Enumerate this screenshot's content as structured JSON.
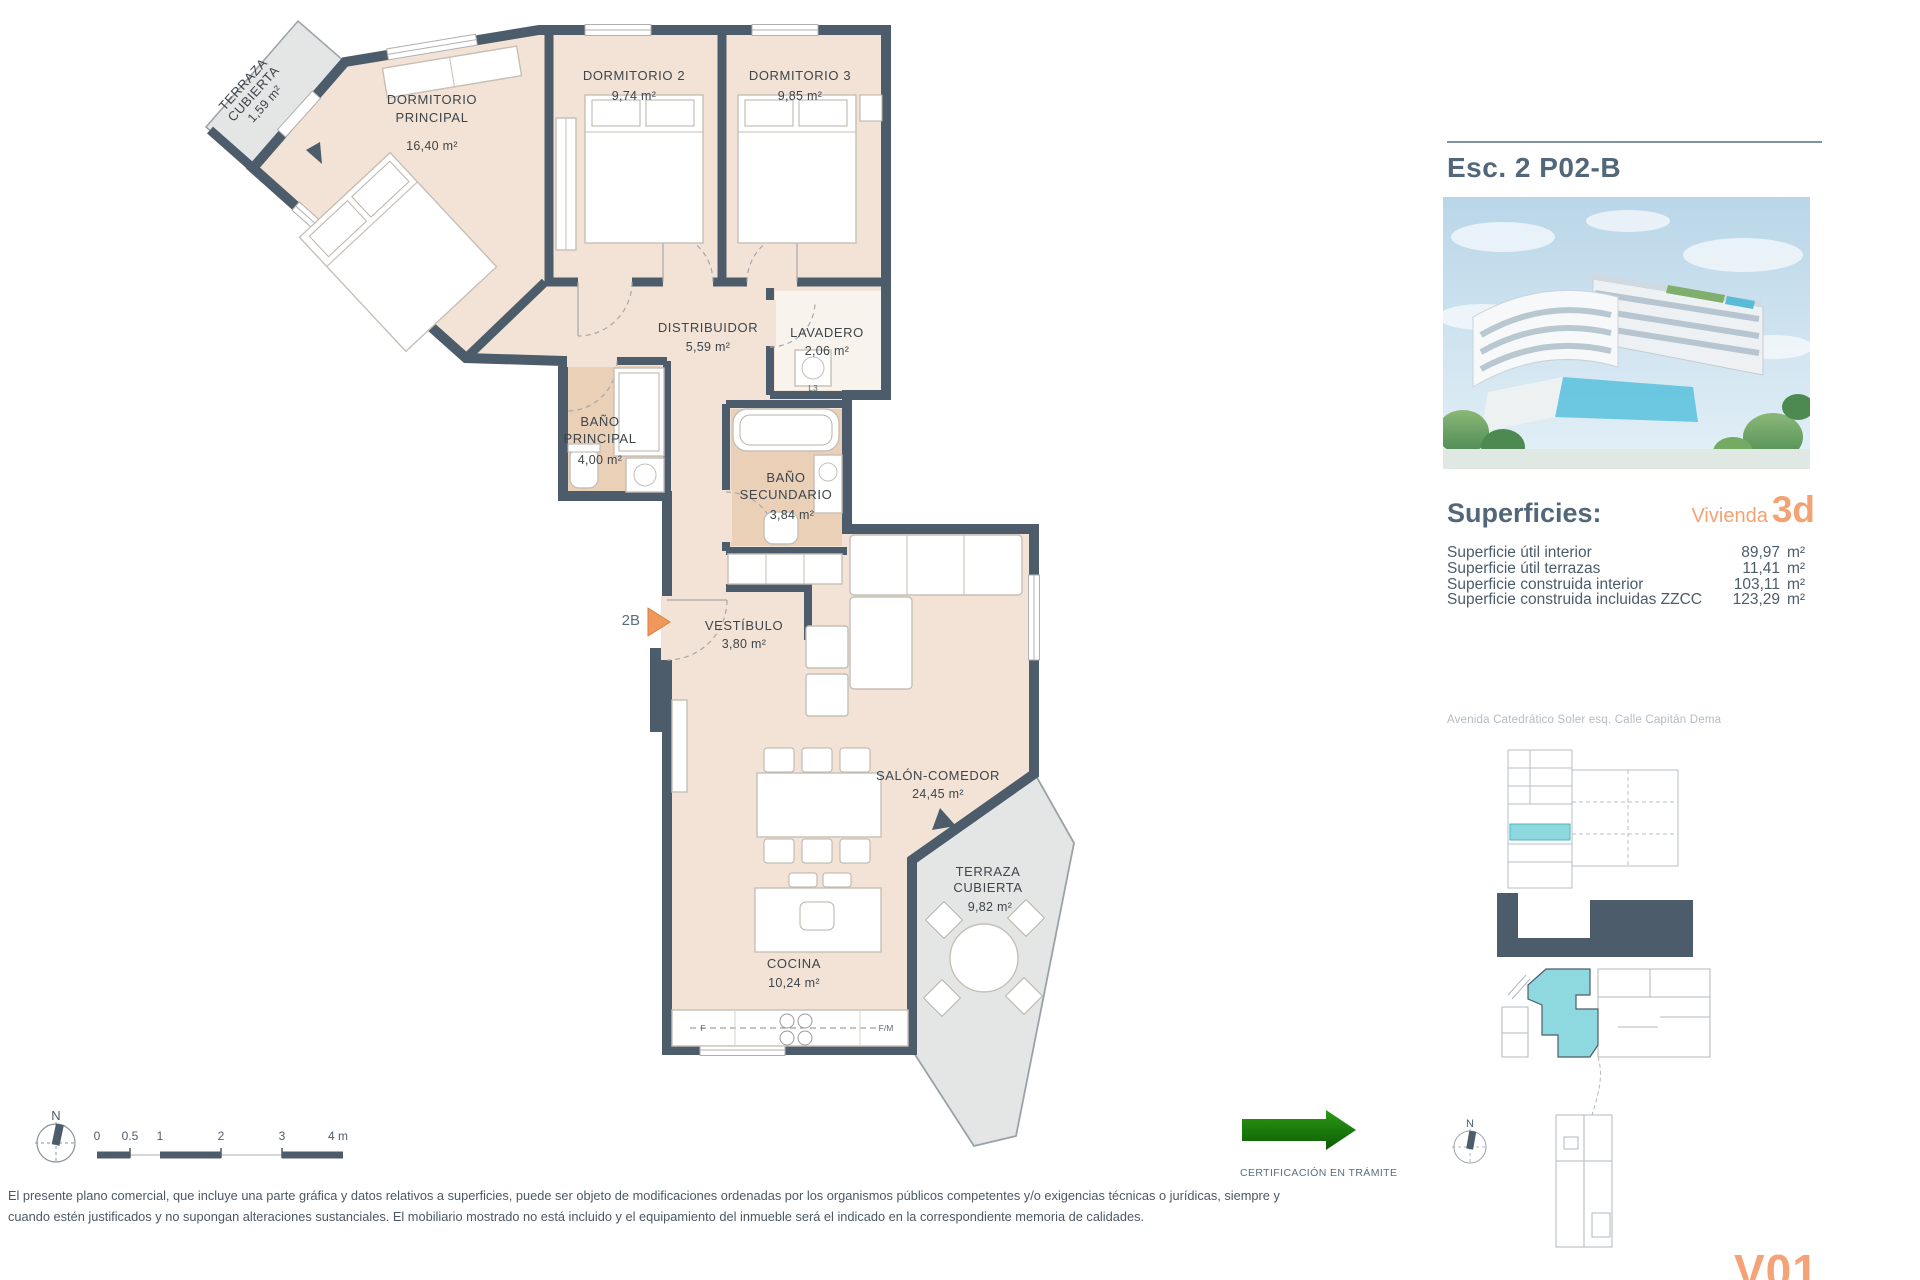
{
  "colors": {
    "wall": "#4d5c6a",
    "room_fill": "#f2e3d6",
    "bath_fill": "#e9d0b7",
    "terrace_fill": "#e4e6e6",
    "highlight_cyan": "#8ed8df",
    "accent_orange": "#f4a273",
    "cert_green": "#1b7e10",
    "title_blue": "#53677a"
  },
  "plan": {
    "rooms": [
      {
        "id": "terraza-norte",
        "l1": "TERRAZA",
        "l2": "CUBIERTA",
        "area": "1,59 m²"
      },
      {
        "id": "dormitorio-principal",
        "l1": "DORMITORIO",
        "l2": "PRINCIPAL",
        "area": "16,40 m²"
      },
      {
        "id": "dormitorio-2",
        "l1": "DORMITORIO 2",
        "area": "9,74 m²"
      },
      {
        "id": "dormitorio-3",
        "l1": "DORMITORIO 3",
        "area": "9,85 m²"
      },
      {
        "id": "distribuidor",
        "l1": "DISTRIBUIDOR",
        "area": "5,59 m²"
      },
      {
        "id": "lavadero",
        "l1": "LAVADERO",
        "area": "2,06 m²"
      },
      {
        "id": "bano-principal",
        "l1": "BAÑO",
        "l2": "PRINCIPAL",
        "area": "4,00 m²"
      },
      {
        "id": "bano-secundario",
        "l1": "BAÑO",
        "l2": "SECUNDARIO",
        "area": "3,84 m²"
      },
      {
        "id": "vestibulo",
        "l1": "VESTÍBULO",
        "area": "3,80 m²"
      },
      {
        "id": "salon-comedor",
        "l1": "SALÓN-COMEDOR",
        "area": "24,45 m²"
      },
      {
        "id": "cocina",
        "l1": "COCINA",
        "area": "10,24 m²"
      },
      {
        "id": "terraza-salon",
        "l1": "TERRAZA",
        "l2": "CUBIERTA",
        "area": "9,82 m²"
      }
    ],
    "entrance_label": "2B",
    "appliances": {
      "lavadero": "L3",
      "kitchen_left": "F",
      "kitchen_right": "F/M"
    },
    "compass": "N",
    "scale_ticks": [
      "0",
      "0.5",
      "1",
      "2",
      "3",
      "4 m"
    ]
  },
  "panel": {
    "title": "Esc. 2 P02-B",
    "superficies": {
      "title": "Superficies:",
      "vivienda": "Vivienda",
      "unit_code": "3d",
      "rows": [
        {
          "label": "Superficie útil interior",
          "value": "89,97",
          "unit": "m²"
        },
        {
          "label": "Superficie útil terrazas",
          "value": "11,41",
          "unit": "m²"
        },
        {
          "label": "Superficie construida interior",
          "value": "103,11",
          "unit": "m²"
        },
        {
          "label": "Superficie construida incluidas ZZCC",
          "value": "123,29",
          "unit": "m²"
        }
      ]
    },
    "address": "Avenida Catedrático Soler esq. Calle Capitán Dema",
    "minimap_compass": "N"
  },
  "footer": {
    "certification": "CERTIFICACIÓN EN TRÁMITE",
    "disclaimer1": "El presente plano comercial, que incluye una parte gráfica y datos relativos a superficies, puede ser objeto de modificaciones ordenadas por los organismos públicos competentes y/o exigencias técnicas o jurídicas, siempre y",
    "disclaimer2": "cuando estén justificados y no supongan alteraciones sustanciales. El mobiliario mostrado no está incluido y el equipamiento del inmueble será el indicado en la correspondiente memoria de calidades.",
    "version": "V01"
  }
}
